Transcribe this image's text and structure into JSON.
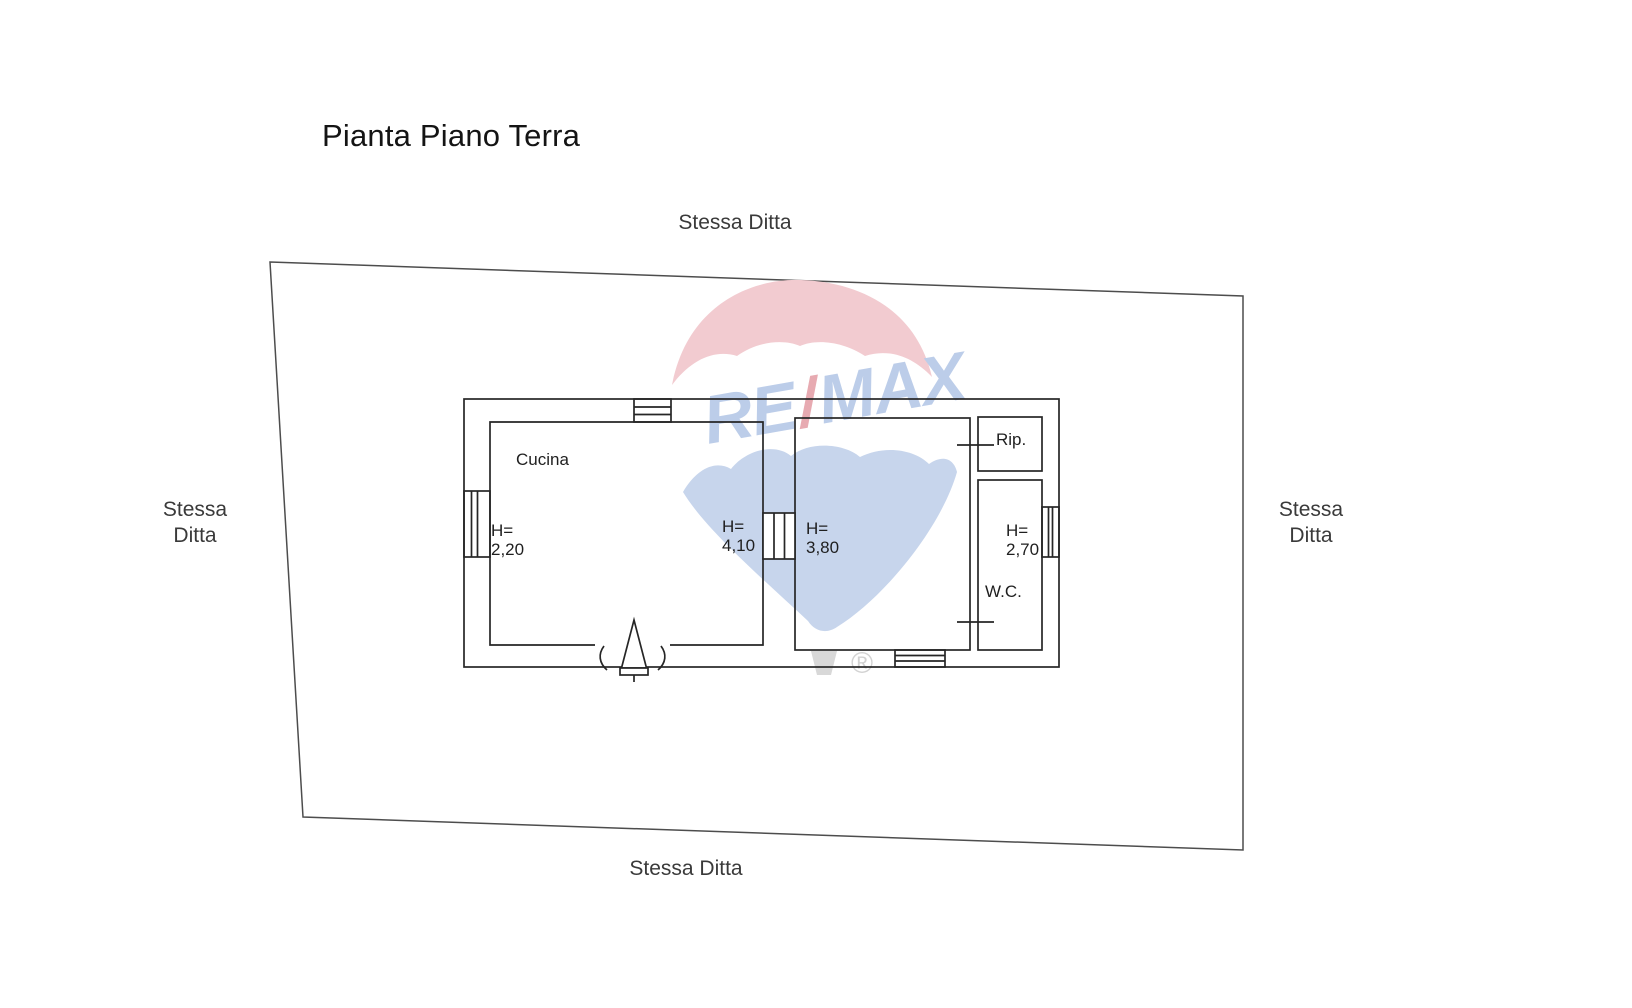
{
  "title": "Pianta Piano Terra",
  "surroundings": {
    "top": "Stessa Ditta",
    "left": "Stessa\nDitta",
    "right": "Stessa\nDitta",
    "bottom": "Stessa Ditta"
  },
  "rooms": {
    "cucina": "Cucina",
    "rip": "Rip.",
    "wc": "W.C."
  },
  "heights": {
    "cucina_left": "H=\n2,20",
    "cucina_right": "H=\n4,10",
    "living": "H=\n3,80",
    "wc": "H=\n2,70"
  },
  "watermark": {
    "re": "RE",
    "slash": "/",
    "max": "MAX",
    "registered": "®",
    "colors": {
      "dome": "#f2cbd0",
      "fan": "#c7d5ec",
      "text_blue": "#bccde9",
      "slash_red": "#e7aab1",
      "basket_gray": "#d8d8d8",
      "registered_gray": "#d2d2d2"
    }
  },
  "plan_colors": {
    "wall": "#262626",
    "boundary": "#4d4d4d"
  }
}
